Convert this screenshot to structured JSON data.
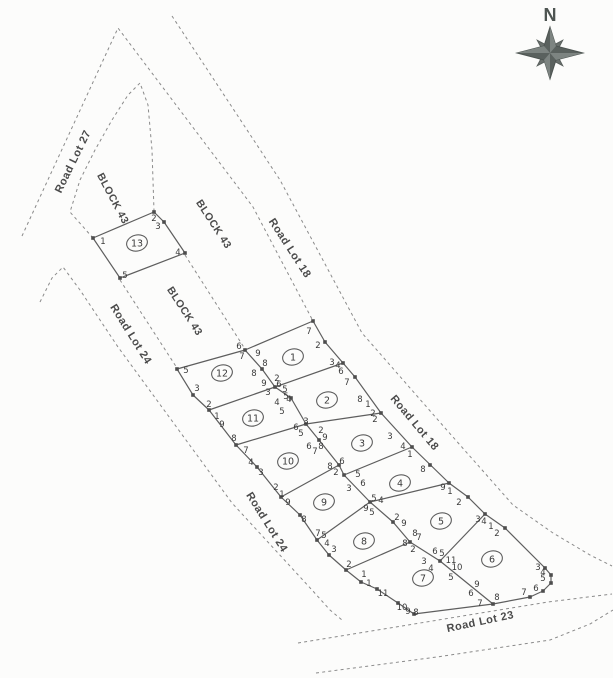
{
  "canvas": {
    "width": 613,
    "height": 678,
    "background": "#fcfcfb"
  },
  "colors": {
    "dashed_line": "#8a8a8a",
    "solid_line": "#5e5e5e",
    "marker": "#4d4d4d",
    "corner_text": "#3a3a3a",
    "road_text": "#4a4a4a",
    "compass": "#5a615e"
  },
  "compass": {
    "north_label": "N",
    "cx": 550,
    "cy": 53
  },
  "road_labels": [
    {
      "text": "Road Lot 27",
      "x": 76,
      "y": 163,
      "rot": -64,
      "size": 11
    },
    {
      "text": "BLOCK 43",
      "x": 110,
      "y": 200,
      "rot": 62,
      "size": 10.5
    },
    {
      "text": "BLOCK 43",
      "x": 211,
      "y": 226,
      "rot": 57,
      "size": 10.5
    },
    {
      "text": "BLOCK 43",
      "x": 182,
      "y": 313,
      "rot": 57,
      "size": 10.5
    },
    {
      "text": "Road Lot 18",
      "x": 287,
      "y": 250,
      "rot": 57,
      "size": 11
    },
    {
      "text": "Road Lot 18",
      "x": 412,
      "y": 425,
      "rot": 50,
      "size": 11
    },
    {
      "text": "Road Lot 24",
      "x": 128,
      "y": 336,
      "rot": 58,
      "size": 11
    },
    {
      "text": "Road Lot 24",
      "x": 264,
      "y": 524,
      "rot": 58,
      "size": 11
    },
    {
      "text": "Road Lot 23",
      "x": 481,
      "y": 625,
      "rot": -12,
      "size": 11
    }
  ],
  "lots": [
    {
      "num": "1",
      "x": 293,
      "y": 357
    },
    {
      "num": "2",
      "x": 327,
      "y": 400
    },
    {
      "num": "3",
      "x": 362,
      "y": 443
    },
    {
      "num": "4",
      "x": 400,
      "y": 483
    },
    {
      "num": "5",
      "x": 441,
      "y": 521
    },
    {
      "num": "6",
      "x": 492,
      "y": 559
    },
    {
      "num": "7",
      "x": 423,
      "y": 578
    },
    {
      "num": "8",
      "x": 364,
      "y": 541
    },
    {
      "num": "9",
      "x": 324,
      "y": 502
    },
    {
      "num": "10",
      "x": 288,
      "y": 461
    },
    {
      "num": "11",
      "x": 253,
      "y": 418
    },
    {
      "num": "12",
      "x": 222,
      "y": 373
    },
    {
      "num": "13",
      "x": 137,
      "y": 243
    }
  ],
  "corner_labels": [
    [
      "1",
      103,
      241
    ],
    [
      "2",
      154,
      218
    ],
    [
      "3",
      158,
      226
    ],
    [
      "4",
      178,
      252
    ],
    [
      "5",
      125,
      275
    ],
    [
      "7",
      309,
      331
    ],
    [
      "2",
      318,
      345
    ],
    [
      "3",
      332,
      362
    ],
    [
      "4",
      338,
      365
    ],
    [
      "6",
      341,
      371
    ],
    [
      "7",
      347,
      382
    ],
    [
      "6",
      239,
      346
    ],
    [
      "7",
      242,
      356
    ],
    [
      "9",
      258,
      353
    ],
    [
      "8",
      265,
      363
    ],
    [
      "8",
      254,
      373
    ],
    [
      "9",
      264,
      383
    ],
    [
      "2",
      277,
      378
    ],
    [
      "6",
      279,
      384
    ],
    [
      "5",
      285,
      389
    ],
    [
      "3",
      268,
      392
    ],
    [
      "5",
      286,
      396
    ],
    [
      "4",
      289,
      399
    ],
    [
      "4",
      277,
      402
    ],
    [
      "5",
      282,
      411
    ],
    [
      "5",
      186,
      370
    ],
    [
      "3",
      197,
      388
    ],
    [
      "2",
      209,
      404
    ],
    [
      "1",
      217,
      416
    ],
    [
      "9",
      222,
      424
    ],
    [
      "8",
      234,
      438
    ],
    [
      "7",
      246,
      450
    ],
    [
      "4",
      251,
      462
    ],
    [
      "3",
      261,
      472
    ],
    [
      "2",
      276,
      487
    ],
    [
      "1",
      282,
      494
    ],
    [
      "9",
      288,
      502
    ],
    [
      "8",
      304,
      519
    ],
    [
      "7",
      318,
      533
    ],
    [
      "5",
      324,
      535
    ],
    [
      "4",
      327,
      543
    ],
    [
      "3",
      334,
      549
    ],
    [
      "2",
      349,
      564
    ],
    [
      "1",
      364,
      574
    ],
    [
      "1",
      369,
      583
    ],
    [
      "11",
      383,
      593
    ],
    [
      "10",
      402,
      607
    ],
    [
      "9",
      408,
      611
    ],
    [
      "8",
      416,
      612
    ],
    [
      "3",
      306,
      421
    ],
    [
      "6",
      296,
      427
    ],
    [
      "5",
      301,
      433
    ],
    [
      "2",
      321,
      430
    ],
    [
      "9",
      325,
      437
    ],
    [
      "8",
      321,
      446
    ],
    [
      "6",
      309,
      446
    ],
    [
      "7",
      315,
      451
    ],
    [
      "6",
      342,
      461
    ],
    [
      "8",
      330,
      466
    ],
    [
      "2",
      336,
      472
    ],
    [
      "5",
      358,
      474
    ],
    [
      "6",
      363,
      483
    ],
    [
      "3",
      349,
      488
    ],
    [
      "5",
      374,
      498
    ],
    [
      "4",
      381,
      500
    ],
    [
      "9",
      366,
      508
    ],
    [
      "5",
      372,
      512
    ],
    [
      "2",
      397,
      517
    ],
    [
      "9",
      404,
      523
    ],
    [
      "8",
      415,
      533
    ],
    [
      "7",
      419,
      537
    ],
    [
      "8",
      405,
      543
    ],
    [
      "2",
      413,
      549
    ],
    [
      "6",
      435,
      551
    ],
    [
      "5",
      442,
      553
    ],
    [
      "3",
      424,
      561
    ],
    [
      "4",
      431,
      568
    ],
    [
      "11",
      451,
      560
    ],
    [
      "10",
      457,
      567
    ],
    [
      "5",
      451,
      577
    ],
    [
      "9",
      477,
      584
    ],
    [
      "6",
      471,
      593
    ],
    [
      "7",
      480,
      603
    ],
    [
      "8",
      497,
      597
    ],
    [
      "8",
      360,
      399
    ],
    [
      "1",
      368,
      404
    ],
    [
      "2",
      373,
      413
    ],
    [
      "2",
      375,
      419
    ],
    [
      "3",
      390,
      436
    ],
    [
      "4",
      403,
      446
    ],
    [
      "1",
      410,
      454
    ],
    [
      "8",
      423,
      469
    ],
    [
      "9",
      443,
      487
    ],
    [
      "1",
      450,
      491
    ],
    [
      "2",
      459,
      502
    ],
    [
      "3",
      478,
      519
    ],
    [
      "4",
      484,
      521
    ],
    [
      "1",
      491,
      526
    ],
    [
      "2",
      497,
      533
    ],
    [
      "3",
      538,
      567
    ],
    [
      "4",
      543,
      572
    ],
    [
      "5",
      543,
      578
    ],
    [
      "6",
      536,
      588
    ],
    [
      "7",
      524,
      592
    ]
  ],
  "solid_lines": [
    {
      "name": "block-outer-boundary",
      "closed": true,
      "points": [
        [
          177,
          369
        ],
        [
          245,
          350
        ],
        [
          313,
          321
        ],
        [
          325,
          342
        ],
        [
          343,
          363
        ],
        [
          355,
          377
        ],
        [
          381,
          413
        ],
        [
          412,
          447
        ],
        [
          449,
          483
        ],
        [
          468,
          497
        ],
        [
          485,
          514
        ],
        [
          505,
          528
        ],
        [
          545,
          568
        ],
        [
          551,
          575
        ],
        [
          551,
          583
        ],
        [
          543,
          591
        ],
        [
          530,
          597
        ],
        [
          493,
          604
        ],
        [
          414,
          614
        ],
        [
          398,
          603
        ],
        [
          377,
          589
        ],
        [
          361,
          582
        ],
        [
          346,
          570
        ],
        [
          329,
          555
        ],
        [
          317,
          540
        ],
        [
          300,
          515
        ],
        [
          281,
          497
        ],
        [
          257,
          467
        ],
        [
          236,
          445
        ],
        [
          209,
          410
        ],
        [
          193,
          395
        ]
      ]
    },
    {
      "name": "lot-13-boundary",
      "closed": true,
      "points": [
        [
          93,
          238
        ],
        [
          154,
          212
        ],
        [
          164,
          222
        ],
        [
          185,
          253
        ],
        [
          120,
          278
        ]
      ]
    },
    {
      "name": "center-spine-line",
      "closed": false,
      "points": [
        [
          245,
          350
        ],
        [
          262,
          369
        ],
        [
          275,
          387
        ],
        [
          291,
          398
        ],
        [
          306,
          424
        ],
        [
          319,
          440
        ],
        [
          339,
          465
        ],
        [
          344,
          475
        ],
        [
          370,
          502
        ],
        [
          393,
          522
        ],
        [
          410,
          542
        ],
        [
          440,
          561
        ],
        [
          493,
          604
        ]
      ]
    },
    {
      "name": "divider-lot1-lot2",
      "closed": false,
      "points": [
        [
          275,
          387
        ],
        [
          343,
          363
        ]
      ]
    },
    {
      "name": "divider-lot12-lot11",
      "closed": false,
      "points": [
        [
          209,
          410
        ],
        [
          275,
          387
        ]
      ]
    },
    {
      "name": "divider-lot11-lot10",
      "closed": false,
      "points": [
        [
          236,
          445
        ],
        [
          306,
          424
        ]
      ]
    },
    {
      "name": "divider-lot2-lot3",
      "closed": false,
      "points": [
        [
          306,
          424
        ],
        [
          381,
          413
        ]
      ]
    },
    {
      "name": "divider-lot10-lot9",
      "closed": false,
      "points": [
        [
          281,
          497
        ],
        [
          339,
          465
        ]
      ]
    },
    {
      "name": "divider-lot3-lot4",
      "closed": false,
      "points": [
        [
          344,
          475
        ],
        [
          412,
          447
        ]
      ]
    },
    {
      "name": "divider-lot9-lot8",
      "closed": false,
      "points": [
        [
          317,
          540
        ],
        [
          370,
          502
        ]
      ]
    },
    {
      "name": "divider-lot4-lot5",
      "closed": false,
      "points": [
        [
          370,
          502
        ],
        [
          449,
          483
        ]
      ]
    },
    {
      "name": "divider-lot8-lot7",
      "closed": false,
      "points": [
        [
          346,
          570
        ],
        [
          410,
          542
        ]
      ]
    },
    {
      "name": "divider-lot5-lot6",
      "closed": false,
      "points": [
        [
          440,
          561
        ],
        [
          485,
          514
        ]
      ]
    }
  ],
  "dashed_lines": [
    {
      "name": "road-lot-27-18-outer-edge",
      "points": [
        [
          22,
          236
        ],
        [
          118,
          28
        ],
        [
          253,
          207
        ],
        [
          313,
          321
        ]
      ]
    },
    {
      "name": "road-lot-18-far-edge",
      "points": [
        [
          172,
          16
        ],
        [
          280,
          180
        ],
        [
          362,
          333
        ],
        [
          445,
          428
        ],
        [
          513,
          505
        ],
        [
          553,
          533
        ],
        [
          590,
          555
        ],
        [
          612,
          566
        ]
      ]
    },
    {
      "name": "block43-inner-corner-curve",
      "points": [
        [
          93,
          238
        ],
        [
          70,
          212
        ],
        [
          80,
          180
        ],
        [
          95,
          150
        ],
        [
          112,
          120
        ],
        [
          128,
          95
        ],
        [
          140,
          83
        ],
        [
          148,
          105
        ],
        [
          152,
          150
        ],
        [
          154,
          211
        ]
      ]
    },
    {
      "name": "block43-divider-upper",
      "points": [
        [
          185,
          255
        ],
        [
          245,
          349
        ]
      ]
    },
    {
      "name": "block43-divider-lower",
      "points": [
        [
          120,
          280
        ],
        [
          177,
          368
        ]
      ]
    },
    {
      "name": "road-lot-24-left-edge",
      "points": [
        [
          40,
          302
        ],
        [
          52,
          278
        ],
        [
          63,
          267
        ],
        [
          80,
          290
        ],
        [
          118,
          347
        ],
        [
          232,
          503
        ],
        [
          312,
          590
        ],
        [
          330,
          610
        ],
        [
          342,
          620
        ]
      ]
    },
    {
      "name": "road-lot-23-upper-edge",
      "points": [
        [
          298,
          643
        ],
        [
          420,
          623
        ],
        [
          548,
          602
        ],
        [
          612,
          594
        ]
      ]
    },
    {
      "name": "road-lot-23-lower-edge",
      "points": [
        [
          316,
          673
        ],
        [
          437,
          657
        ],
        [
          550,
          640
        ],
        [
          590,
          624
        ],
        [
          613,
          610
        ]
      ]
    }
  ],
  "markers": [
    [
      93,
      238
    ],
    [
      154,
      212
    ],
    [
      164,
      222
    ],
    [
      185,
      253
    ],
    [
      120,
      278
    ],
    [
      177,
      369
    ],
    [
      193,
      395
    ],
    [
      209,
      410
    ],
    [
      236,
      445
    ],
    [
      257,
      467
    ],
    [
      281,
      497
    ],
    [
      300,
      515
    ],
    [
      317,
      540
    ],
    [
      329,
      555
    ],
    [
      346,
      570
    ],
    [
      361,
      582
    ],
    [
      377,
      589
    ],
    [
      398,
      603
    ],
    [
      414,
      614
    ],
    [
      493,
      604
    ],
    [
      530,
      597
    ],
    [
      543,
      591
    ],
    [
      551,
      583
    ],
    [
      551,
      575
    ],
    [
      545,
      568
    ],
    [
      505,
      528
    ],
    [
      485,
      514
    ],
    [
      468,
      497
    ],
    [
      449,
      483
    ],
    [
      430,
      465
    ],
    [
      412,
      447
    ],
    [
      381,
      413
    ],
    [
      355,
      377
    ],
    [
      343,
      363
    ],
    [
      325,
      342
    ],
    [
      313,
      321
    ],
    [
      245,
      350
    ],
    [
      262,
      369
    ],
    [
      275,
      387
    ],
    [
      291,
      398
    ],
    [
      306,
      424
    ],
    [
      319,
      440
    ],
    [
      339,
      465
    ],
    [
      344,
      475
    ],
    [
      370,
      502
    ],
    [
      393,
      522
    ],
    [
      410,
      542
    ],
    [
      440,
      561
    ]
  ]
}
